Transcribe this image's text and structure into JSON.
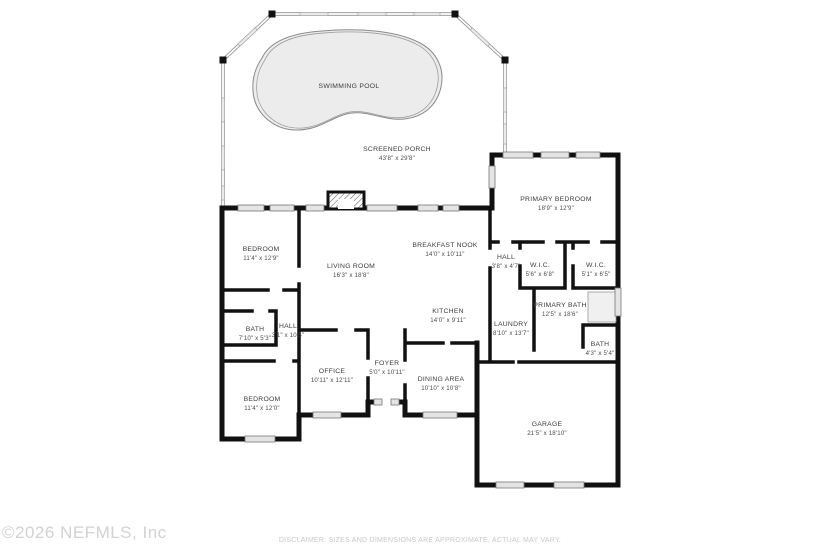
{
  "footer": {
    "copyright": "©2026 NEFMLS, Inc",
    "disclaimer": "DISCLAIMER: SIZES AND DIMENSIONS ARE APPROXIMATE, ACTUAL MAY VARY."
  },
  "pool": {
    "label": "SWIMMING POOL"
  },
  "rooms": [
    {
      "name": "SCREENED PORCH",
      "dims": "43'8\" x 29'8\""
    },
    {
      "name": "PRIMARY BEDROOM",
      "dims": "18'9\" x 12'9\""
    },
    {
      "name": "BEDROOM",
      "dims": "11'4\" x 12'9\""
    },
    {
      "name": "LIVING ROOM",
      "dims": "16'3\" x 18'8\""
    },
    {
      "name": "BREAKFAST NOOK",
      "dims": "14'0\" x 10'11\""
    },
    {
      "name": "HALL",
      "dims": "3'8\" x 4'7\""
    },
    {
      "name": "W.I.C.",
      "dims": "5'6\" x 6'8\""
    },
    {
      "name": "W.I.C.",
      "dims": "5'1\" x 6'5\""
    },
    {
      "name": "KITCHEN",
      "dims": "14'0\" x 9'11\""
    },
    {
      "name": "PRIMARY BATH",
      "dims": "12'5\" x 18'6\""
    },
    {
      "name": "LAUNDRY",
      "dims": "8'10\" x 13'7\""
    },
    {
      "name": "BATH",
      "dims": "7'10\" x 5'3\""
    },
    {
      "name": "HALL",
      "dims": "3'1\" x 10'5\""
    },
    {
      "name": "BATH",
      "dims": "4'3\" x 5'4\""
    },
    {
      "name": "OFFICE",
      "dims": "10'11\" x 12'11\""
    },
    {
      "name": "FOYER",
      "dims": "5'0\" x 10'11\""
    },
    {
      "name": "DINING AREA",
      "dims": "10'10\" x 10'8\""
    },
    {
      "name": "BEDROOM",
      "dims": "11'4\" x 12'0\""
    },
    {
      "name": "GARAGE",
      "dims": "21'5\" x 18'10\""
    }
  ],
  "colors": {
    "wall": "#111111",
    "pool_fill": "#ececec",
    "window_fill": "#e4e4e4",
    "label_text": "#3b3b3b",
    "footer_text": "#c9c9c9"
  }
}
